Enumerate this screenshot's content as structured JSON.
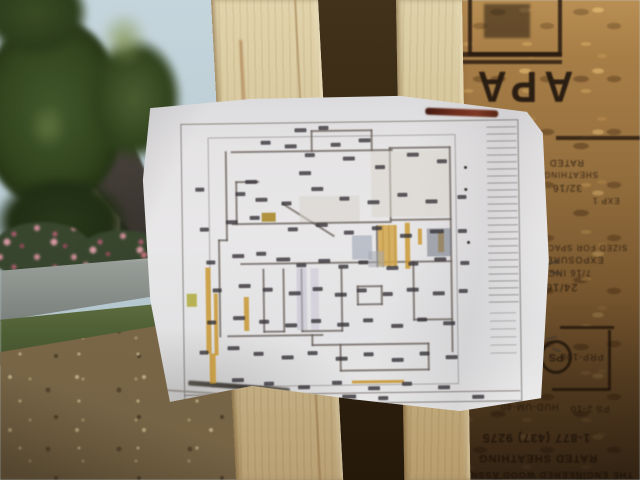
{
  "meta": {
    "type": "photograph",
    "subject": "House floor plan sheet tacked to new wall framing at a construction site",
    "width": 640,
    "height": 480
  },
  "colors": {
    "sky": "#bccfd8",
    "foliage": "#2c4019",
    "osb_board": "#a57a42",
    "lumber": "#d6c59a",
    "paper": "#eceaec",
    "plan_highlight": "#cf9b33",
    "marker_stroke": "#6b2718",
    "pencil_stroke": "#55514b"
  },
  "osb_stamp": {
    "brand": "APA",
    "orientation": "upside-down",
    "text_lines": [
      {
        "t": "RATED",
        "x": 549,
        "y": 158,
        "s": 9
      },
      {
        "t": "SHEATHING",
        "x": 543,
        "y": 170,
        "s": 8
      },
      {
        "t": "32/16",
        "x": 552,
        "y": 182,
        "s": 10
      },
      {
        "t": "EXP 1",
        "x": 592,
        "y": 196,
        "s": 8
      },
      {
        "t": "SIZED FOR SPACING",
        "x": 530,
        "y": 243,
        "s": 8
      },
      {
        "t": "EXPOSURE 1",
        "x": 536,
        "y": 255,
        "s": 9
      },
      {
        "t": "7/16 INCH",
        "x": 540,
        "y": 268,
        "s": 9
      },
      {
        "t": "24/16",
        "x": 545,
        "y": 281,
        "s": 11
      },
      {
        "t": "PRP-108",
        "x": 560,
        "y": 352,
        "s": 9
      },
      {
        "t": "HUD-UM-40",
        "x": 500,
        "y": 402,
        "s": 9
      },
      {
        "t": "PS 2-10",
        "x": 570,
        "y": 404,
        "s": 9
      },
      {
        "t": "1-877 (437) 9275",
        "x": 482,
        "y": 432,
        "s": 12,
        "b": true
      },
      {
        "t": "RATED SHEATHING",
        "x": 478,
        "y": 452,
        "s": 11,
        "b": true
      },
      {
        "t": "THE ENGINEERED WOOD ASSN",
        "x": 470,
        "y": 470,
        "s": 9,
        "b": true
      }
    ],
    "bars": [
      [
        458,
        52,
        104,
        5
      ],
      [
        458,
        60,
        104,
        4
      ],
      [
        556,
        136,
        84,
        4
      ],
      [
        560,
        326,
        54,
        3
      ],
      [
        608,
        330,
        3,
        60
      ],
      [
        552,
        388,
        58,
        3
      ]
    ],
    "circle": {
      "x": 540,
      "y": 340,
      "w": 26,
      "h": 28,
      "t": "PS"
    }
  },
  "scribbles": [
    [
      544,
      262,
      16,
      2,
      -18
    ],
    [
      549,
      272,
      13,
      2,
      12
    ],
    [
      546,
      337,
      11,
      2,
      -14
    ],
    [
      552,
      349,
      9,
      2,
      18
    ]
  ],
  "plan": {
    "walls": [
      [
        232,
        150,
        162,
        2
      ],
      [
        312,
        130,
        62,
        2
      ],
      [
        312,
        130,
        2,
        22
      ],
      [
        372,
        130,
        2,
        22
      ],
      [
        226,
        150,
        2,
        90
      ],
      [
        218,
        238,
        2,
        98
      ],
      [
        218,
        238,
        10,
        2
      ],
      [
        226,
        334,
        96,
        2
      ],
      [
        310,
        344,
        118,
        2
      ],
      [
        310,
        334,
        2,
        12
      ],
      [
        426,
        344,
        2,
        28
      ],
      [
        338,
        370,
        90,
        2
      ],
      [
        338,
        344,
        2,
        28
      ],
      [
        450,
        148,
        2,
        206
      ],
      [
        390,
        148,
        62,
        2
      ],
      [
        390,
        148,
        2,
        74
      ],
      [
        390,
        220,
        62,
        2
      ],
      [
        232,
        222,
        160,
        2
      ],
      [
        240,
        262,
        212,
        2
      ],
      [
        283,
        202,
        62,
        2,
        33
      ],
      [
        262,
        268,
        2,
        64
      ],
      [
        282,
        268,
        2,
        64
      ],
      [
        262,
        330,
        22,
        2
      ],
      [
        300,
        268,
        2,
        64
      ],
      [
        340,
        268,
        2,
        64
      ],
      [
        300,
        330,
        42,
        2
      ],
      [
        356,
        286,
        26,
        2
      ],
      [
        356,
        304,
        26,
        2
      ],
      [
        356,
        286,
        2,
        20
      ],
      [
        380,
        286,
        2,
        20
      ],
      [
        376,
        226,
        2,
        42
      ],
      [
        382,
        226,
        2,
        42
      ],
      [
        388,
        226,
        2,
        42
      ],
      [
        394,
        226,
        2,
        42
      ],
      [
        412,
        262,
        2,
        60
      ],
      [
        412,
        320,
        40,
        2
      ],
      [
        236,
        180,
        24,
        2
      ],
      [
        236,
        180,
        2,
        44
      ],
      [
        182,
        393,
        336,
        1
      ]
    ],
    "highlights": [
      [
        205,
        266,
        5,
        86
      ],
      [
        213,
        292,
        4,
        62
      ],
      [
        243,
        296,
        5,
        34
      ],
      [
        262,
        212,
        14,
        9,
        "#a8851e"
      ],
      [
        378,
        226,
        19,
        41,
        "#d8a94a"
      ],
      [
        405,
        224,
        5,
        46
      ],
      [
        418,
        230,
        4,
        16
      ],
      [
        350,
        381,
        52,
        3
      ],
      [
        208,
        352,
        6,
        30
      ],
      [
        186,
        292,
        10,
        13,
        "#b4ae3c"
      ],
      [
        438,
        234,
        6,
        20
      ]
    ],
    "shades": [
      [
        352,
        236,
        20,
        24,
        "#99a2b4"
      ],
      [
        368,
        252,
        16,
        16,
        "#a7abb2"
      ],
      [
        296,
        268,
        10,
        62,
        "#c6c2d6"
      ],
      [
        310,
        268,
        8,
        62,
        "#cfcbdc"
      ],
      [
        427,
        230,
        24,
        28,
        "#6d7584"
      ],
      [
        372,
        152,
        78,
        66,
        "#dcd8d0"
      ],
      [
        300,
        196,
        60,
        26,
        "#dbd7cf"
      ]
    ],
    "labels": [
      [
        296,
        128,
        12
      ],
      [
        320,
        126,
        10
      ],
      [
        262,
        140,
        10
      ],
      [
        286,
        144,
        12
      ],
      [
        332,
        143,
        10
      ],
      [
        360,
        139,
        12
      ],
      [
        306,
        153,
        10
      ],
      [
        344,
        157,
        12
      ],
      [
        408,
        154,
        12
      ],
      [
        438,
        161,
        10
      ],
      [
        376,
        166,
        10
      ],
      [
        300,
        171,
        12
      ],
      [
        196,
        186,
        9
      ],
      [
        246,
        179,
        12
      ],
      [
        236,
        191,
        10
      ],
      [
        256,
        197,
        12
      ],
      [
        282,
        201,
        10
      ],
      [
        312,
        187,
        12
      ],
      [
        340,
        197,
        10
      ],
      [
        368,
        201,
        12
      ],
      [
        398,
        194,
        10
      ],
      [
        426,
        201,
        12
      ],
      [
        458,
        197,
        9
      ],
      [
        200,
        226,
        9
      ],
      [
        226,
        219,
        12
      ],
      [
        250,
        215,
        10
      ],
      [
        288,
        227,
        10
      ],
      [
        316,
        223,
        12
      ],
      [
        344,
        231,
        10
      ],
      [
        372,
        227,
        10
      ],
      [
        400,
        235,
        12
      ],
      [
        430,
        231,
        14
      ],
      [
        458,
        231,
        9
      ],
      [
        206,
        259,
        9
      ],
      [
        232,
        253,
        12
      ],
      [
        256,
        251,
        10
      ],
      [
        276,
        257,
        14
      ],
      [
        296,
        263,
        10
      ],
      [
        318,
        259,
        12
      ],
      [
        338,
        265,
        10
      ],
      [
        358,
        261,
        10
      ],
      [
        386,
        267,
        12
      ],
      [
        408,
        263,
        10
      ],
      [
        434,
        259,
        12
      ],
      [
        460,
        263,
        9
      ],
      [
        212,
        287,
        9
      ],
      [
        238,
        283,
        12
      ],
      [
        262,
        287,
        10
      ],
      [
        288,
        291,
        12
      ],
      [
        312,
        287,
        10
      ],
      [
        334,
        293,
        12
      ],
      [
        356,
        289,
        10
      ],
      [
        382,
        293,
        10
      ],
      [
        406,
        289,
        12
      ],
      [
        432,
        293,
        12
      ],
      [
        458,
        291,
        9
      ],
      [
        206,
        319,
        9
      ],
      [
        232,
        315,
        12
      ],
      [
        258,
        319,
        10
      ],
      [
        284,
        323,
        12
      ],
      [
        310,
        319,
        10
      ],
      [
        336,
        323,
        12
      ],
      [
        362,
        319,
        10
      ],
      [
        390,
        325,
        12
      ],
      [
        416,
        319,
        10
      ],
      [
        442,
        323,
        12
      ],
      [
        198,
        349,
        9
      ],
      [
        226,
        345,
        12
      ],
      [
        252,
        351,
        10
      ],
      [
        280,
        355,
        12
      ],
      [
        306,
        351,
        10
      ],
      [
        334,
        357,
        12
      ],
      [
        362,
        353,
        10
      ],
      [
        390,
        359,
        12
      ],
      [
        418,
        353,
        10
      ],
      [
        444,
        357,
        12
      ],
      [
        230,
        377,
        12
      ],
      [
        262,
        381,
        10
      ],
      [
        296,
        385,
        12
      ],
      [
        330,
        381,
        10
      ],
      [
        366,
        387,
        12
      ],
      [
        400,
        383,
        10
      ],
      [
        436,
        387,
        12
      ],
      [
        340,
        395,
        14
      ],
      [
        376,
        397,
        10
      ],
      [
        470,
        397,
        12
      ]
    ],
    "nails": [
      [
        465,
        168
      ],
      [
        465,
        190
      ],
      [
        467,
        243
      ]
    ]
  }
}
